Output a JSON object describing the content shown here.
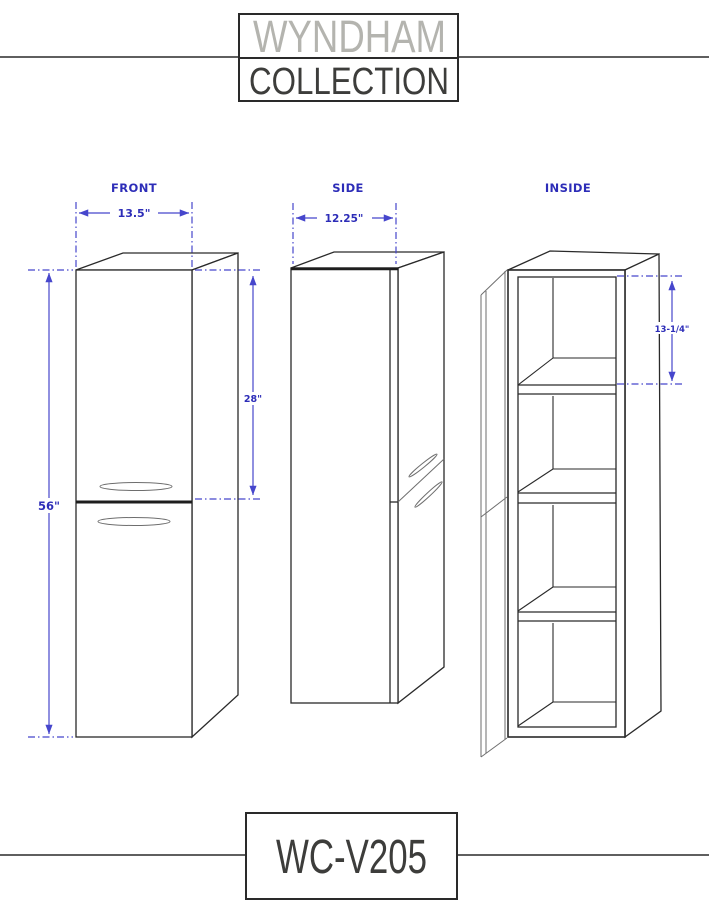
{
  "brand": {
    "name_top": "WYNDHAM",
    "name_bottom": "COLLECTION"
  },
  "model": {
    "code": "WC-V205"
  },
  "views": {
    "front": {
      "label": "FRONT",
      "width": "13.5\"",
      "height": "56\"",
      "upper_section": "28\""
    },
    "side": {
      "label": "SIDE",
      "depth": "12.25\""
    },
    "inside": {
      "label": "INSIDE",
      "opening_height": "13-1/4\""
    }
  },
  "colors": {
    "dimension_blue": "#4646cc",
    "label_blue": "#2d2db8",
    "drawing_black": "#2a2a2a",
    "logo_gray": "#b4b4af",
    "text_dark": "#3d3d3b"
  }
}
